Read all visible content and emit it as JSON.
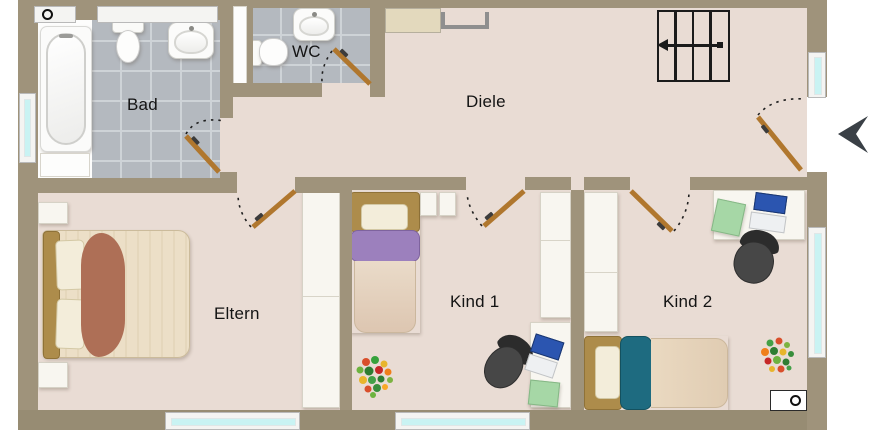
{
  "floorplan": {
    "rooms": [
      {
        "id": "bad",
        "label": "Bad"
      },
      {
        "id": "wc",
        "label": "WC"
      },
      {
        "id": "diele",
        "label": "Diele"
      },
      {
        "id": "eltern",
        "label": "Eltern"
      },
      {
        "id": "kind1",
        "label": "Kind 1"
      },
      {
        "id": "kind2",
        "label": "Kind 2"
      }
    ],
    "colors": {
      "wall": "#9f937b",
      "floor": "#e9dcd4",
      "bath_tile": "#b4b9bf",
      "tile_grout": "#ced3d7",
      "window_glass": "#c9f3f3",
      "door_leaf": "#b0772e",
      "parents_blanket_accent": "#ae6f56",
      "kid1_blanket_accent": "#9c80bd",
      "kid2_blanket_accent": "#1e6b80",
      "desk_mat_green": "#a6d7a6",
      "laptop_screen_blue": "#2b55b0",
      "office_chair_gray": "#3a3a3a",
      "stairs_outline": "#1b1b1b",
      "entry_arrow": "#3a4046"
    },
    "symbols": [
      "stairs-icon",
      "entry-arrow-icon",
      "ceiling-lamp-symbol",
      "wall-outlet-symbol"
    ],
    "furniture": [
      "bathtub",
      "toilet",
      "washbasin",
      "double-bed",
      "nightstand",
      "wardrobe",
      "single-bed",
      "desk",
      "office-chair",
      "laptop",
      "desk-mat",
      "toy-pile",
      "sideboard"
    ]
  }
}
